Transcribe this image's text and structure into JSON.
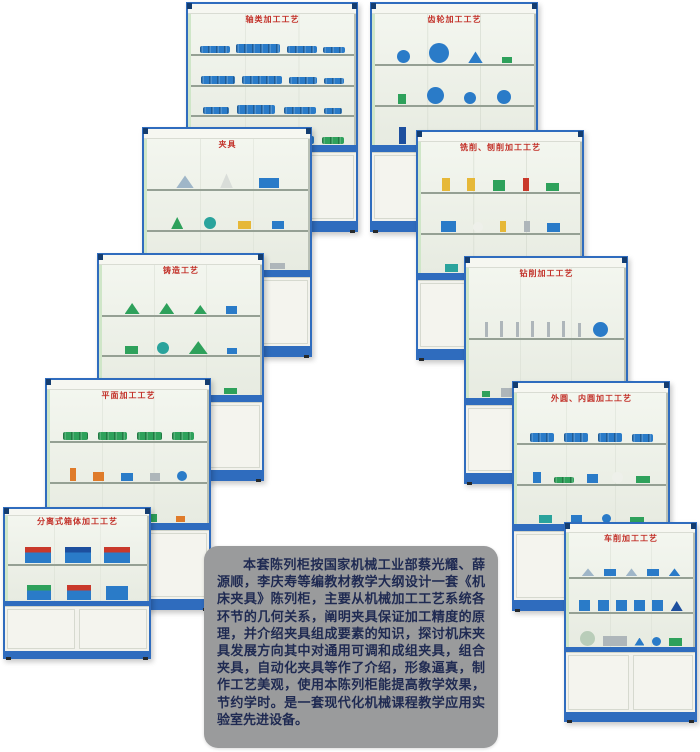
{
  "page": {
    "background": "#ffffff"
  },
  "colors": {
    "frame_blue": "#2f6cbe",
    "corner_navy": "#143d70",
    "title_red": "#c23028",
    "glass_light": "#eef1e9",
    "cupboard_white": "#f2f2ec",
    "panel_gray": "#9a9b9c",
    "panel_text": "#1f2a52",
    "model_blue": "#2a7bc8",
    "model_green": "#2ea15b",
    "model_red": "#c9392b",
    "model_yellow": "#e6b838"
  },
  "description": {
    "text": "本套陈列柜按国家机械工业部蔡光耀、薛源顺，李庆寿等编教材教学大纲设计一套《机床夹具》陈列柜，主要从机械加工工艺系统各环节的几何关系，阐明夹具保证加工精度的原理，并介绍夹具组成要素的知识，探讨机床夹具发展方向其中对通用可调和成组夹具，组合夹具，自动化夹具等作了介绍，形象逼真，制作工艺美观，使用本陈列柜能提高教学效果，节约学时。是一套现代化机械课程教学应用实验室先进设备。"
  },
  "cabinets": [
    {
      "name": "shaft-machining",
      "title": "轴类加工工艺",
      "x": 186,
      "y": 2,
      "w": 172,
      "h": 230,
      "z": 1,
      "shelves": [
        [
          {
            "s": "shaft",
            "c": "#2a7bc8",
            "w": 30,
            "h": 7
          },
          {
            "s": "shaft",
            "c": "#2a7bc8",
            "w": 44,
            "h": 9
          },
          {
            "s": "shaft",
            "c": "#2a7bc8",
            "w": 30,
            "h": 7
          },
          {
            "s": "shaft",
            "c": "#2a7bc8",
            "w": 22,
            "h": 6
          }
        ],
        [
          {
            "s": "shaft",
            "c": "#2a7bc8",
            "w": 34,
            "h": 8
          },
          {
            "s": "shaft",
            "c": "#2a7bc8",
            "w": 40,
            "h": 8
          },
          {
            "s": "shaft",
            "c": "#2a7bc8",
            "w": 28,
            "h": 7
          },
          {
            "s": "shaft",
            "c": "#2a7bc8",
            "w": 20,
            "h": 6
          }
        ],
        [
          {
            "s": "shaft",
            "c": "#2a7bc8",
            "w": 26,
            "h": 7
          },
          {
            "s": "shaft",
            "c": "#2a7bc8",
            "w": 38,
            "h": 9
          },
          {
            "s": "shaft",
            "c": "#2a7bc8",
            "w": 32,
            "h": 7
          },
          {
            "s": "shaft",
            "c": "#2a7bc8",
            "w": 18,
            "h": 6
          }
        ],
        [
          {
            "s": "shaft",
            "c": "#2ea15b",
            "w": 28,
            "h": 8
          },
          {
            "s": "shaft",
            "c": "#2a7bc8",
            "w": 40,
            "h": 9
          },
          {
            "s": "shaft",
            "c": "#2a7bc8",
            "w": 30,
            "h": 8
          },
          {
            "s": "shaft",
            "c": "#2ea15b",
            "w": 22,
            "h": 7
          }
        ]
      ]
    },
    {
      "name": "gear-machining",
      "title": "齿轮加工工艺",
      "x": 370,
      "y": 2,
      "w": 168,
      "h": 230,
      "z": 1,
      "shelves": [
        [
          {
            "s": "circle",
            "c": "#2a7bc8",
            "w": 13,
            "h": 13
          },
          {
            "s": "circle",
            "c": "#2a7bc8",
            "w": 20,
            "h": 20
          },
          {
            "s": "tri",
            "c": "#2a7bc8",
            "w": 15,
            "h": 12
          },
          {
            "s": "rect",
            "c": "#2ea15b",
            "w": 10,
            "h": 6
          }
        ],
        [
          {
            "s": "rect",
            "c": "#2ea15b",
            "w": 8,
            "h": 10
          },
          {
            "s": "circle",
            "c": "#2a7bc8",
            "w": 17,
            "h": 17
          },
          {
            "s": "circle",
            "c": "#2a7bc8",
            "w": 12,
            "h": 12
          },
          {
            "s": "circle",
            "c": "#2a7bc8",
            "w": 14,
            "h": 14
          }
        ],
        [
          {
            "s": "rect",
            "c": "#1d4f9e",
            "w": 7,
            "h": 17
          },
          {
            "s": "tri",
            "c": "#2a7bc8",
            "w": 16,
            "h": 12
          },
          {
            "s": "circle",
            "c": "#2a7bc8",
            "w": 11,
            "h": 11
          },
          {
            "s": "rect",
            "c": "#c9392b",
            "w": 16,
            "h": 4
          }
        ]
      ]
    },
    {
      "name": "fixtures",
      "title": "夹具",
      "x": 142,
      "y": 127,
      "w": 170,
      "h": 230,
      "z": 2,
      "shelves": [
        [
          {
            "s": "tri",
            "c": "#9fb6c8",
            "w": 18,
            "h": 13
          },
          {
            "s": "tri",
            "c": "#d9ddd9",
            "w": 13,
            "h": 15
          },
          {
            "s": "rect",
            "c": "#2a7bc8",
            "w": 20,
            "h": 10
          }
        ],
        [
          {
            "s": "tri",
            "c": "#2ea15b",
            "w": 12,
            "h": 12
          },
          {
            "s": "circle",
            "c": "#2aa39c",
            "w": 12,
            "h": 12
          },
          {
            "s": "rect",
            "c": "#e6b838",
            "w": 13,
            "h": 8
          },
          {
            "s": "rect",
            "c": "#2a7bc8",
            "w": 12,
            "h": 8
          }
        ],
        [
          {
            "s": "rect",
            "c": "#2ea15b",
            "w": 17,
            "h": 8
          },
          {
            "s": "rect",
            "c": "#2a7bc8",
            "w": 13,
            "h": 10
          },
          {
            "s": "tri",
            "c": "#2a7bc8",
            "w": 11,
            "h": 10
          },
          {
            "s": "rect",
            "c": "#aeb6ba",
            "w": 15,
            "h": 6
          }
        ]
      ]
    },
    {
      "name": "milling-planing",
      "title": "铣削、刨削加工工艺",
      "x": 416,
      "y": 130,
      "w": 168,
      "h": 230,
      "z": 2,
      "shelves": [
        [
          {
            "s": "rect",
            "c": "#e6b838",
            "w": 8,
            "h": 13
          },
          {
            "s": "rect",
            "c": "#e6b838",
            "w": 8,
            "h": 13
          },
          {
            "s": "rect",
            "c": "#2ea15b",
            "w": 12,
            "h": 11
          },
          {
            "s": "rect",
            "c": "#c9392b",
            "w": 6,
            "h": 13
          },
          {
            "s": "rect",
            "c": "#2ea15b",
            "w": 13,
            "h": 8
          }
        ],
        [
          {
            "s": "rect",
            "c": "#2a7bc8",
            "w": 15,
            "h": 11
          },
          {
            "s": "circle",
            "c": "#eef0ea",
            "w": 10,
            "h": 10
          },
          {
            "s": "rect",
            "c": "#e6b838",
            "w": 6,
            "h": 11
          },
          {
            "s": "rect",
            "c": "#aeb6ba",
            "w": 6,
            "h": 11
          },
          {
            "s": "rect",
            "c": "#2a7bc8",
            "w": 13,
            "h": 9
          }
        ],
        [
          {
            "s": "rect",
            "c": "#2aa39c",
            "w": 13,
            "h": 8
          },
          {
            "s": "rect",
            "c": "#df7b2a",
            "w": 11,
            "h": 8
          },
          {
            "s": "rect",
            "c": "#2a7bc8",
            "w": 15,
            "h": 8
          },
          {
            "s": "rect",
            "c": "#2ea15b",
            "w": 10,
            "h": 6
          }
        ]
      ]
    },
    {
      "name": "casting-process",
      "title": "铸造工艺",
      "x": 97,
      "y": 253,
      "w": 167,
      "h": 228,
      "z": 3,
      "shelves": [
        [
          {
            "s": "tri",
            "c": "#2ea15b",
            "w": 15,
            "h": 11
          },
          {
            "s": "tri",
            "c": "#2ea15b",
            "w": 15,
            "h": 11
          },
          {
            "s": "tri",
            "c": "#2ea15b",
            "w": 13,
            "h": 9
          },
          {
            "s": "rect",
            "c": "#2a7bc8",
            "w": 11,
            "h": 8
          }
        ],
        [
          {
            "s": "rect",
            "c": "#2ea15b",
            "w": 13,
            "h": 8
          },
          {
            "s": "circle",
            "c": "#2aa39c",
            "w": 12,
            "h": 12
          },
          {
            "s": "tri",
            "c": "#2ea15b",
            "w": 19,
            "h": 13
          },
          {
            "s": "rect",
            "c": "#2a7bc8",
            "w": 10,
            "h": 6
          }
        ],
        [
          {
            "s": "tri",
            "c": "#2ea15b",
            "w": 17,
            "h": 10
          },
          {
            "s": "tri",
            "c": "#2ea15b",
            "w": 13,
            "h": 9
          },
          {
            "s": "rect",
            "c": "#2a7bc8",
            "w": 11,
            "h": 8
          },
          {
            "s": "rect",
            "c": "#2ea15b",
            "w": 13,
            "h": 6
          }
        ]
      ]
    },
    {
      "name": "drilling-machining",
      "title": "钻削加工工艺",
      "x": 464,
      "y": 256,
      "w": 164,
      "h": 228,
      "z": 3,
      "shelves": [
        [
          {
            "s": "rect",
            "c": "#aeb6ba",
            "w": 3,
            "h": 15
          },
          {
            "s": "rect",
            "c": "#aeb6ba",
            "w": 3,
            "h": 16
          },
          {
            "s": "rect",
            "c": "#aeb6ba",
            "w": 3,
            "h": 15
          },
          {
            "s": "rect",
            "c": "#aeb6ba",
            "w": 3,
            "h": 16
          },
          {
            "s": "rect",
            "c": "#aeb6ba",
            "w": 3,
            "h": 15
          },
          {
            "s": "rect",
            "c": "#aeb6ba",
            "w": 3,
            "h": 16
          },
          {
            "s": "rect",
            "c": "#aeb6ba",
            "w": 3,
            "h": 14
          },
          {
            "s": "circle",
            "c": "#2a7bc8",
            "w": 15,
            "h": 15
          }
        ],
        [
          {
            "s": "rect",
            "c": "#2ea15b",
            "w": 8,
            "h": 6
          },
          {
            "s": "rect",
            "c": "#aeb6ba",
            "w": 13,
            "h": 9
          },
          {
            "s": "rect",
            "c": "#2ea15b",
            "w": 8,
            "h": 6
          },
          {
            "s": "rect",
            "c": "#c9392b",
            "w": 12,
            "h": 4
          },
          {
            "s": "circle",
            "c": "#c9392b",
            "w": 13,
            "h": 13
          },
          {
            "s": "rect",
            "c": "#aeb6ba",
            "w": 4,
            "h": 13
          },
          {
            "s": "tri",
            "c": "#c9392b",
            "w": 9,
            "h": 9
          }
        ]
      ]
    },
    {
      "name": "plane-machining",
      "title": "平面加工工艺",
      "x": 45,
      "y": 378,
      "w": 166,
      "h": 232,
      "z": 4,
      "shelves": [
        [
          {
            "s": "shaft",
            "c": "#2ea15b",
            "w": 25,
            "h": 8
          },
          {
            "s": "shaft",
            "c": "#2ea15b",
            "w": 29,
            "h": 8
          },
          {
            "s": "shaft",
            "c": "#2ea15b",
            "w": 25,
            "h": 8
          },
          {
            "s": "shaft",
            "c": "#2ea15b",
            "w": 22,
            "h": 8
          }
        ],
        [
          {
            "s": "rect",
            "c": "#df7b2a",
            "w": 6,
            "h": 13
          },
          {
            "s": "rect",
            "c": "#df7b2a",
            "w": 11,
            "h": 9
          },
          {
            "s": "rect",
            "c": "#2a7bc8",
            "w": 12,
            "h": 8
          },
          {
            "s": "rect",
            "c": "#aeb6ba",
            "w": 10,
            "h": 8
          },
          {
            "s": "circle",
            "c": "#2a7bc8",
            "w": 10,
            "h": 10
          }
        ],
        [
          {
            "s": "rect",
            "c": "#2a7bc8",
            "w": 13,
            "h": 8
          },
          {
            "s": "shaft",
            "c": "#aeb6ba",
            "w": 22,
            "h": 6
          },
          {
            "s": "rect",
            "c": "#2ea15b",
            "w": 11,
            "h": 8
          },
          {
            "s": "rect",
            "c": "#df7b2a",
            "w": 9,
            "h": 6
          }
        ]
      ]
    },
    {
      "name": "cylindrical-machining",
      "title": "外圆、内圆加工工艺",
      "x": 512,
      "y": 381,
      "w": 158,
      "h": 230,
      "z": 4,
      "shelves": [
        [
          {
            "s": "shaft",
            "c": "#2a7bc8",
            "w": 24,
            "h": 9
          },
          {
            "s": "shaft",
            "c": "#2a7bc8",
            "w": 24,
            "h": 9
          },
          {
            "s": "shaft",
            "c": "#2a7bc8",
            "w": 24,
            "h": 9
          },
          {
            "s": "shaft",
            "c": "#2a7bc8",
            "w": 21,
            "h": 8
          }
        ],
        [
          {
            "s": "rect",
            "c": "#2a7bc8",
            "w": 8,
            "h": 11
          },
          {
            "s": "shaft",
            "c": "#2ea15b",
            "w": 20,
            "h": 6
          },
          {
            "s": "rect",
            "c": "#2a7bc8",
            "w": 11,
            "h": 9
          },
          {
            "s": "circle",
            "c": "#eef0ea",
            "w": 11,
            "h": 11
          },
          {
            "s": "rect",
            "c": "#2ea15b",
            "w": 14,
            "h": 7
          }
        ],
        [
          {
            "s": "rect",
            "c": "#2aa39c",
            "w": 13,
            "h": 8
          },
          {
            "s": "rect",
            "c": "#2a7bc8",
            "w": 11,
            "h": 8
          },
          {
            "s": "circle",
            "c": "#2a7bc8",
            "w": 9,
            "h": 9
          },
          {
            "s": "rect",
            "c": "#2ea15b",
            "w": 14,
            "h": 6
          }
        ]
      ]
    },
    {
      "name": "split-housing-machining",
      "title": "分离式箱体加工工艺",
      "x": 3,
      "y": 507,
      "w": 148,
      "h": 152,
      "z": 5,
      "shelves": [
        [
          {
            "s": "housing",
            "c": "#2a7bc8",
            "c2": "#c9392b",
            "w": 26,
            "h": 16
          },
          {
            "s": "housing",
            "c": "#2a7bc8",
            "c2": "#1d4f9e",
            "w": 26,
            "h": 16
          },
          {
            "s": "housing",
            "c": "#2a7bc8",
            "c2": "#c9392b",
            "w": 26,
            "h": 16
          }
        ],
        [
          {
            "s": "housing",
            "c": "#2a7bc8",
            "c2": "#2ea15b",
            "w": 24,
            "h": 15
          },
          {
            "s": "housing",
            "c": "#2a7bc8",
            "c2": "#c9392b",
            "w": 24,
            "h": 15
          },
          {
            "s": "housing",
            "c": "#2a7bc8",
            "c2": "#2a7bc8",
            "w": 22,
            "h": 14
          }
        ]
      ]
    },
    {
      "name": "turning-machining",
      "title": "车削加工工艺",
      "x": 564,
      "y": 522,
      "w": 133,
      "h": 200,
      "z": 5,
      "shelves": [
        [
          {
            "s": "tri",
            "c": "#9fb6c8",
            "w": 13,
            "h": 8
          },
          {
            "s": "rect",
            "c": "#2a7bc8",
            "w": 12,
            "h": 7
          },
          {
            "s": "tri",
            "c": "#9fb6c8",
            "w": 12,
            "h": 8
          },
          {
            "s": "rect",
            "c": "#2a7bc8",
            "w": 12,
            "h": 7
          },
          {
            "s": "tri",
            "c": "#2a7bc8",
            "w": 12,
            "h": 8
          }
        ],
        [
          {
            "s": "rect",
            "c": "#2a7bc8",
            "w": 11,
            "h": 11
          },
          {
            "s": "rect",
            "c": "#2a7bc8",
            "w": 11,
            "h": 11
          },
          {
            "s": "rect",
            "c": "#2a7bc8",
            "w": 11,
            "h": 11
          },
          {
            "s": "rect",
            "c": "#2a7bc8",
            "w": 11,
            "h": 11
          },
          {
            "s": "rect",
            "c": "#2a7bc8",
            "w": 11,
            "h": 11
          },
          {
            "s": "tri",
            "c": "#1d4f9e",
            "w": 12,
            "h": 10
          }
        ],
        [
          {
            "s": "circle",
            "c": "#b9cdb9",
            "w": 15,
            "h": 15
          },
          {
            "s": "rect",
            "c": "#aeb6ba",
            "w": 24,
            "h": 10
          },
          {
            "s": "tri",
            "c": "#2a7bc8",
            "w": 10,
            "h": 8
          },
          {
            "s": "circle",
            "c": "#2a7bc8",
            "w": 9,
            "h": 9
          },
          {
            "s": "rect",
            "c": "#2ea15b",
            "w": 13,
            "h": 8
          }
        ]
      ]
    }
  ]
}
